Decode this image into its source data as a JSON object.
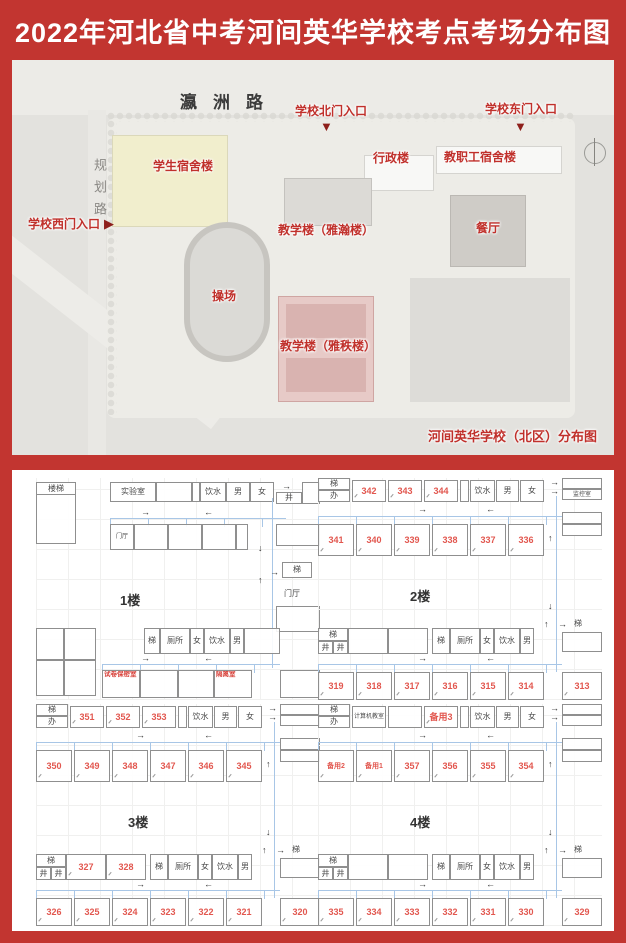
{
  "title": "2022年河北省中考河间英华学校考点考场分布图",
  "icons": {
    "arrow_right": "→",
    "arrow_left": "←",
    "arrow_up": "↑",
    "arrow_down": "↓",
    "triangle_down": "▼",
    "triangle_right": "▶"
  },
  "map": {
    "road_top": "瀛洲路",
    "road_left": "规划路",
    "entrance_west": "学校西门入口",
    "entrance_north": "学校北门入口",
    "entrance_east": "学校东门入口",
    "dorm": "学生宿舍楼",
    "admin": "行政楼",
    "staff_dorm": "教职工宿舍楼",
    "teaching1": "教学楼（雅瀚楼）",
    "dining": "餐厅",
    "playground": "操场",
    "teaching2": "教学楼（雅秩楼）",
    "caption": "河间英华学校（北区）分布图"
  },
  "floor1": {
    "label": "1楼",
    "stairwell": "楼梯",
    "lab": "实验室",
    "water_top": "饮水",
    "male_top": "男",
    "female_top": "女",
    "well": "井",
    "foyer_left": "门厅",
    "foyer_right": "门厅",
    "stair_right": "梯",
    "stair_mid": "梯",
    "toilet": "厕所",
    "female_bot": "女",
    "water_bot": "饮水",
    "male_bot": "男",
    "paper_room": "试卷保密室",
    "isolation_room": "隔离室"
  },
  "floor2": {
    "label": "2楼",
    "stair": "梯",
    "office": "办",
    "rooms_top": [
      "342",
      "343",
      "344"
    ],
    "water_top": "饮水",
    "male_top": "男",
    "female_top": "女",
    "corner_room": "监控室",
    "rooms_mid": [
      "341",
      "340",
      "339",
      "338",
      "337",
      "336"
    ],
    "stair_left": "梯",
    "well_a": "井",
    "well_b": "井",
    "stair_mid": "梯",
    "toilet": "厕所",
    "female_bot": "女",
    "water_bot": "饮水",
    "male_bot": "男",
    "rooms_bottom": [
      "319",
      "318",
      "317",
      "316",
      "315",
      "314"
    ],
    "room_corner_bottom": "313",
    "stair_right": "梯"
  },
  "floor3": {
    "label": "3楼",
    "stair": "梯",
    "office": "办",
    "rooms_top": [
      "351",
      "352",
      "353"
    ],
    "water_top": "饮水",
    "male_top": "男",
    "female_top": "女",
    "rooms_extra": [
      "327",
      "328"
    ],
    "rooms_mid": [
      "350",
      "349",
      "348",
      "347",
      "346",
      "345"
    ],
    "stair_left": "梯",
    "well_a": "井",
    "well_b": "井",
    "stair_mid": "梯",
    "toilet": "厕所",
    "female_bot": "女",
    "water_bot": "饮水",
    "male_bot": "男",
    "rooms_bottom": [
      "326",
      "325",
      "324",
      "323",
      "322",
      "321"
    ],
    "room_corner_bottom": "320",
    "stair_right": "梯"
  },
  "floor4": {
    "label": "4楼",
    "stair": "梯",
    "office": "办",
    "computer_room": "计算机教室",
    "spare_top": "备用3",
    "water_top": "饮水",
    "male_top": "男",
    "female_top": "女",
    "rooms_mid": [
      "备用2",
      "备用1",
      "357",
      "356",
      "355",
      "354"
    ],
    "stair_left": "梯",
    "well_a": "井",
    "well_b": "井",
    "stair_mid": "梯",
    "toilet": "厕所",
    "female_bot": "女",
    "water_bot": "饮水",
    "male_bot": "男",
    "rooms_bottom": [
      "335",
      "334",
      "333",
      "332",
      "331",
      "330"
    ],
    "room_corner_bottom": "329",
    "stair_right": "梯"
  }
}
